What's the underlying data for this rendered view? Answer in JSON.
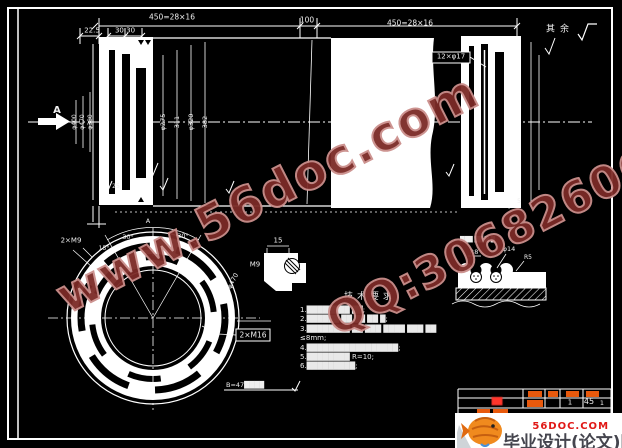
{
  "main_view": {
    "dim_segment_left": "450=28×16",
    "dim_100": "100",
    "dim_segment_right": "450=28×16",
    "dim_22_5": "22.5",
    "dim_30_30": "30,30",
    "surface_note": "其余",
    "holes_label": "12×φ17",
    "section_arrow_label": "A",
    "dia_left": [
      "φ400",
      "φ470",
      "φ380"
    ],
    "dia_mid": [
      "φ275",
      "311",
      "φ320",
      "382"
    ],
    "roughness_25": "25",
    "roughness_5": "5"
  },
  "flange_view": {
    "thread_label": "2×M9",
    "angle_left": "30°",
    "angle_right": "30°",
    "angle_small": "15°",
    "dia_label": "φ470",
    "bolt_label": "2×M16",
    "bottom_note": "B=47████",
    "view_label": "A"
  },
  "boss_detail": {
    "dim_15": "15",
    "thread_label": "M9"
  },
  "groove_detail": {
    "caption": "███ ██ █:█",
    "radius_label": "R8",
    "dia_label": "φ14",
    "radius_small": "R5"
  },
  "tech_req": {
    "title": "技术要求",
    "lines": [
      "1.████████ ██;",
      "2.██████ ██ ██ ██ █;",
      "3.████████ ██ ███ ████ ███ ██",
      "≤8mm;",
      "4.█████████████████;",
      "5.████████ R=10;",
      "6.█████████;"
    ]
  },
  "title_block": {
    "part_name": "██",
    "qty": "1",
    "material": "45",
    "sheet": "1"
  },
  "logo": {
    "site": "56DOC.COM",
    "name": "毕业设计(论文)网"
  },
  "watermark": {
    "url": "www.56doc.com",
    "qq": "QQ:306826066"
  }
}
